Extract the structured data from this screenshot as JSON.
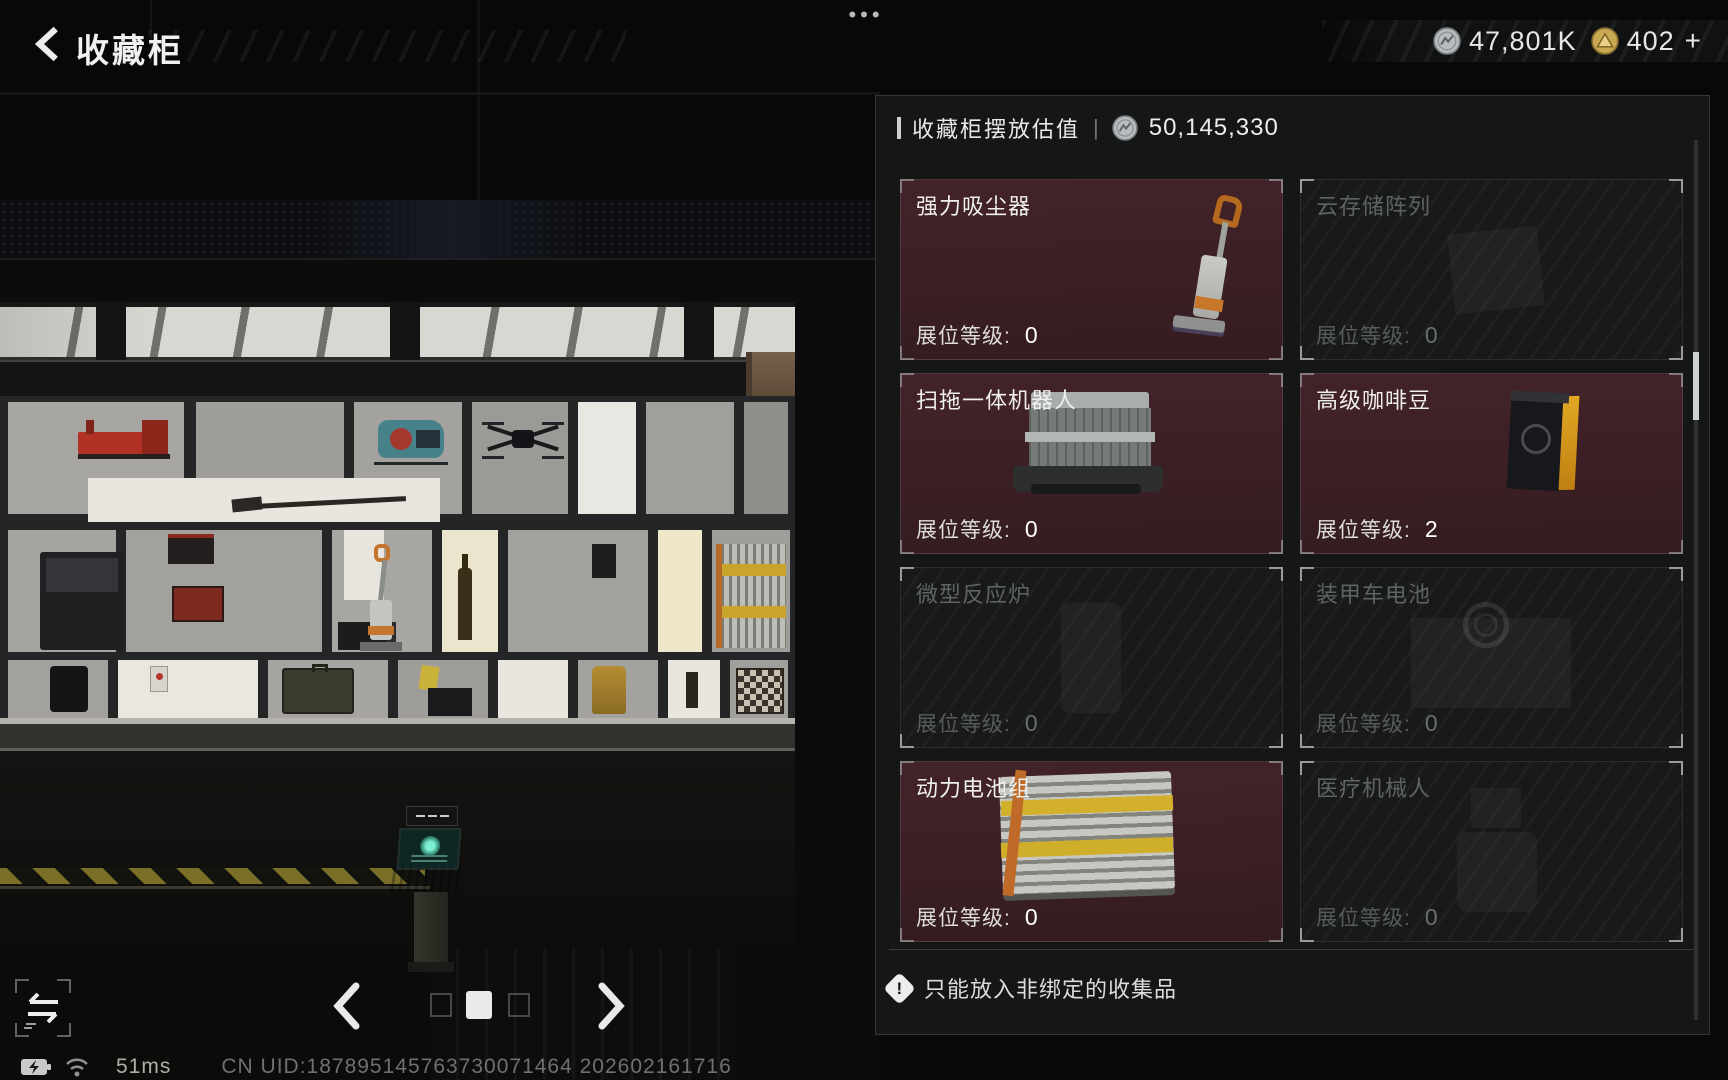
{
  "top_bar": {
    "title": "收藏柜",
    "menu_dots": "•••",
    "currencies": [
      {
        "icon": "silver-coin-icon",
        "value": "47,801K"
      },
      {
        "icon": "gold-coin-icon",
        "value": "402",
        "add": "+"
      }
    ]
  },
  "panel": {
    "header": {
      "label": "收藏柜摆放估值",
      "separator": "|",
      "icon": "silver-coin-icon",
      "value": "50,145,330"
    },
    "items": [
      {
        "name": "强力吸尘器",
        "level_label": "展位等级:",
        "level": "0",
        "active": true,
        "image": "vacuum-cleaner"
      },
      {
        "name": "云存储阵列",
        "level_label": "展位等级:",
        "level": "0",
        "active": false,
        "image": "cloud-storage-array"
      },
      {
        "name": "扫拖一体机器人",
        "level_label": "展位等级:",
        "level": "0",
        "active": true,
        "image": "mopping-robot"
      },
      {
        "name": "高级咖啡豆",
        "level_label": "展位等级:",
        "level": "2",
        "active": true,
        "image": "premium-coffee-beans"
      },
      {
        "name": "微型反应炉",
        "level_label": "展位等级:",
        "level": "0",
        "active": false,
        "image": "micro-reactor"
      },
      {
        "name": "装甲车电池",
        "level_label": "展位等级:",
        "level": "0",
        "active": false,
        "image": "armored-vehicle-battery"
      },
      {
        "name": "动力电池组",
        "level_label": "展位等级:",
        "level": "0",
        "active": true,
        "image": "power-battery-pack"
      },
      {
        "name": "医疗机械人",
        "level_label": "展位等级:",
        "level": "0",
        "active": false,
        "image": "medical-robot"
      }
    ],
    "warning": {
      "glyph": "!",
      "text": "只能放入非绑定的收集品"
    }
  },
  "status_bar": {
    "ping": "51ms",
    "uid": "CN UID:187895145763730071464 202602161716"
  },
  "colors": {
    "card_active_bg": "#3e2125",
    "card_dim_bg": "#181a19",
    "panel_bg": "#151717",
    "accent_text": "#eceeec",
    "gold": "#c8a850",
    "silver": "#b9bdc1"
  }
}
